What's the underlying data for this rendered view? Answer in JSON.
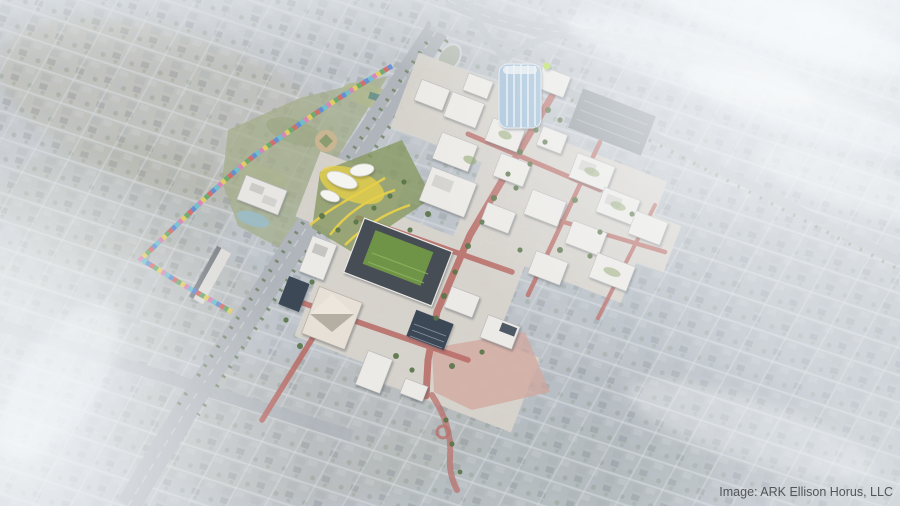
{
  "window": {
    "width": 900,
    "height": 506,
    "kind": "aerial-masterplan-rendering"
  },
  "credit": {
    "text": "Image: ARK Ellison Horus, LLC",
    "color": "#44494d"
  },
  "palette": {
    "haze_white": "#f5f9fc",
    "city_light": "#c7ccd0",
    "city_dark": "#9aa2a9",
    "city_tan": "#b3a996",
    "road_gray": "#a8aeb3",
    "highway_gray": "#b2b8bd",
    "site_ground": "#d7d3cc",
    "building_white": "#eceae6",
    "roof_dark": "#474d54",
    "solar_blue": "#3d4857",
    "turf_green": "#6f9447",
    "tree_green": "#5a7549",
    "park_green": "#98a47a",
    "path_yellow": "#e6cf4a",
    "tower_glass_blue": "#a3c0d8",
    "pond_blue": "#8fb6c4",
    "street_red": "#b96e69",
    "plaza_pink": "#d2a79e",
    "trail_colors": [
      "#4f7fd0",
      "#d05a55",
      "#58a05a",
      "#e3c84e",
      "#d478b0",
      "#5bb9c9"
    ]
  }
}
